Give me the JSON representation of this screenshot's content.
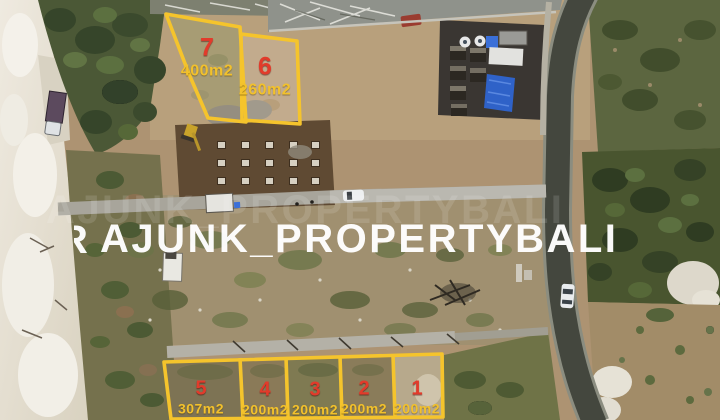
{
  "watermark": {
    "text": "AJUNK_PROPERTYBALI",
    "partial_glyph": "R",
    "color": "#ffffff"
  },
  "plots": [
    {
      "number": "7",
      "area": "400m2"
    },
    {
      "number": "6",
      "area": "260m2"
    },
    {
      "number": "5",
      "area": "307m2"
    },
    {
      "number": "4",
      "area": "200m2"
    },
    {
      "number": "3",
      "area": "200m2"
    },
    {
      "number": "2",
      "area": "200m2"
    },
    {
      "number": "1",
      "area": "200m2"
    }
  ],
  "style": {
    "plot_outline_color": "#f5c42c",
    "plot_number_color": "#e23b2b",
    "plot_area_color": "#f2c12c",
    "watermark_color": "#ffffff"
  }
}
